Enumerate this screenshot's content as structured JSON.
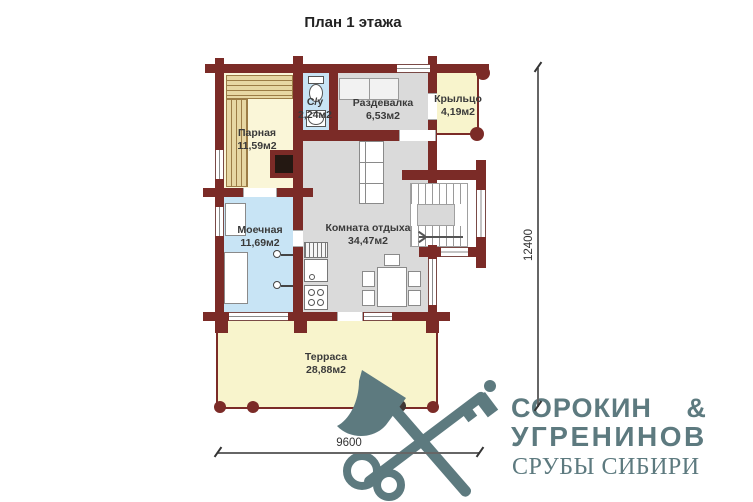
{
  "title": "План 1 этажа",
  "rooms": {
    "parnaya": {
      "name": "Парная",
      "area": "11,59м2"
    },
    "su": {
      "name": "С/у",
      "area": "2,24м2"
    },
    "razdevalka": {
      "name": "Раздевалка",
      "area": "6,53м2"
    },
    "kryltso": {
      "name": "Крыльцо",
      "area": "4,19м2"
    },
    "moechnaya": {
      "name": "Моечная",
      "area": "11,69м2"
    },
    "komnata": {
      "name": "Комната отдыха",
      "area": "34,47м2"
    },
    "terrasa": {
      "name": "Терраса",
      "area": "28,88м2"
    }
  },
  "dimensions": {
    "height_mm": "12400",
    "width_mm": "9600"
  },
  "logo": {
    "line1": "СОРОКИН &",
    "line2": "УГРЕНИНОВ",
    "line3": "СРУБЫ СИБИРИ"
  },
  "colors": {
    "wall": "#7b2b27",
    "wet_room_fill": "#c8e4f5",
    "sauna_fill": "#faf6d8",
    "gray_room_fill": "#dadada",
    "terrace_fill": "#f8f4cc",
    "bench_fill": "#e7d7a3",
    "logo": "#5d7a7f"
  }
}
